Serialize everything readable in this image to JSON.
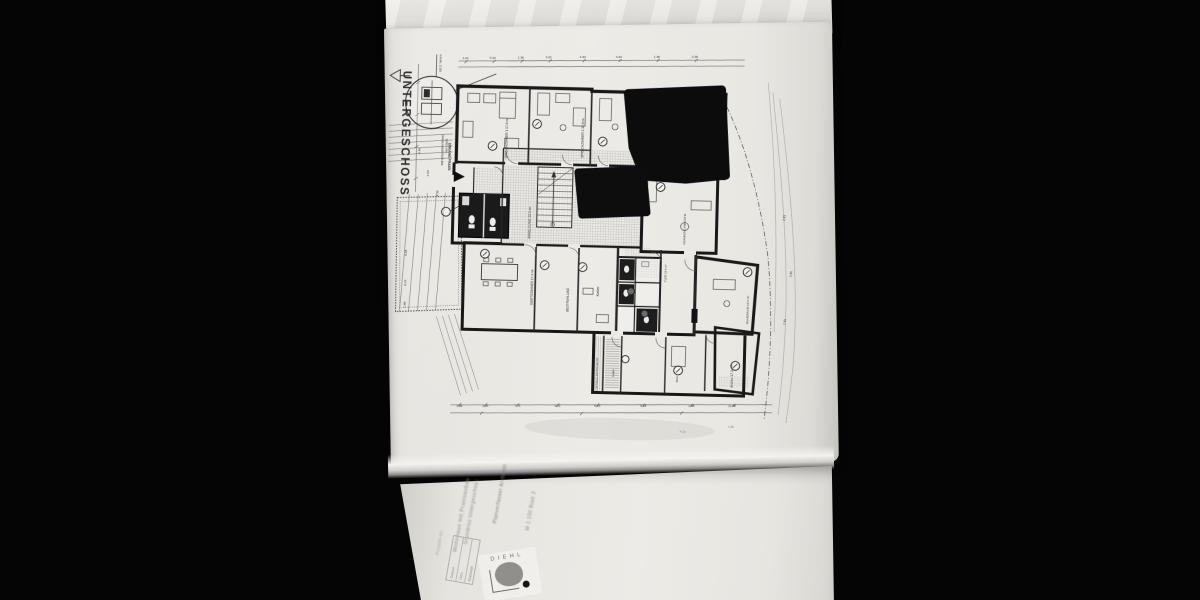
{
  "plan": {
    "title": "UNTERGESCHOSS",
    "notes": {
      "kanal": "KANAL ∅150",
      "detail_line1": "DREIKAMMERGRUBE",
      "detail_line2": "6000 l INH.",
      "entrance": "EINGANG PRAXIS",
      "luftung": "LÜFTUNG LICHTSCHACHT"
    },
    "rooms": [
      "SPRECHZIMMER 1  17.6 m²",
      "SPRECHZIMMER 2  15.8 m²",
      "ANMELDUNG  22.9 m²",
      "WARTEZIMMER  17.4 m²",
      "BESTRAHLUNG",
      "Keller",
      "KRANKENGYMNASTIK",
      "FLUR  13.6 m²",
      "RUHERAUM  16.4 m²",
      "Archiv  17.3 m²",
      "Lager",
      "Abst."
    ],
    "dims": {
      "top": [
        "1.01",
        "5.23",
        "1.38",
        "2.01",
        "1.63",
        "4.23",
        "1.38",
        "3.38"
      ],
      "bottom": [
        "1.38",
        "2.26",
        "7.74",
        "1.63",
        "5.49",
        "9.48",
        "1.38",
        "11.48"
      ],
      "left": [
        "5.48",
        "8.19",
        "1.88"
      ],
      "right": [
        "2.81",
        "3.81",
        "7.81"
      ],
      "inner": [
        "9.48",
        "2.63",
        "4.38"
      ],
      "extra": [
        "4.13",
        "1.88"
      ]
    }
  },
  "title_block": {
    "logo": "DIEHL",
    "lines": [
      "Wohnhaus mit Praxisanbau",
      "Grundriss Untergeschoss",
      "Planverfasser  Architekt",
      "M 1:100  Blatt 3",
      "Projekt-Nr."
    ],
    "table": [
      "Datum",
      "Gez.",
      "Maßstab"
    ]
  }
}
